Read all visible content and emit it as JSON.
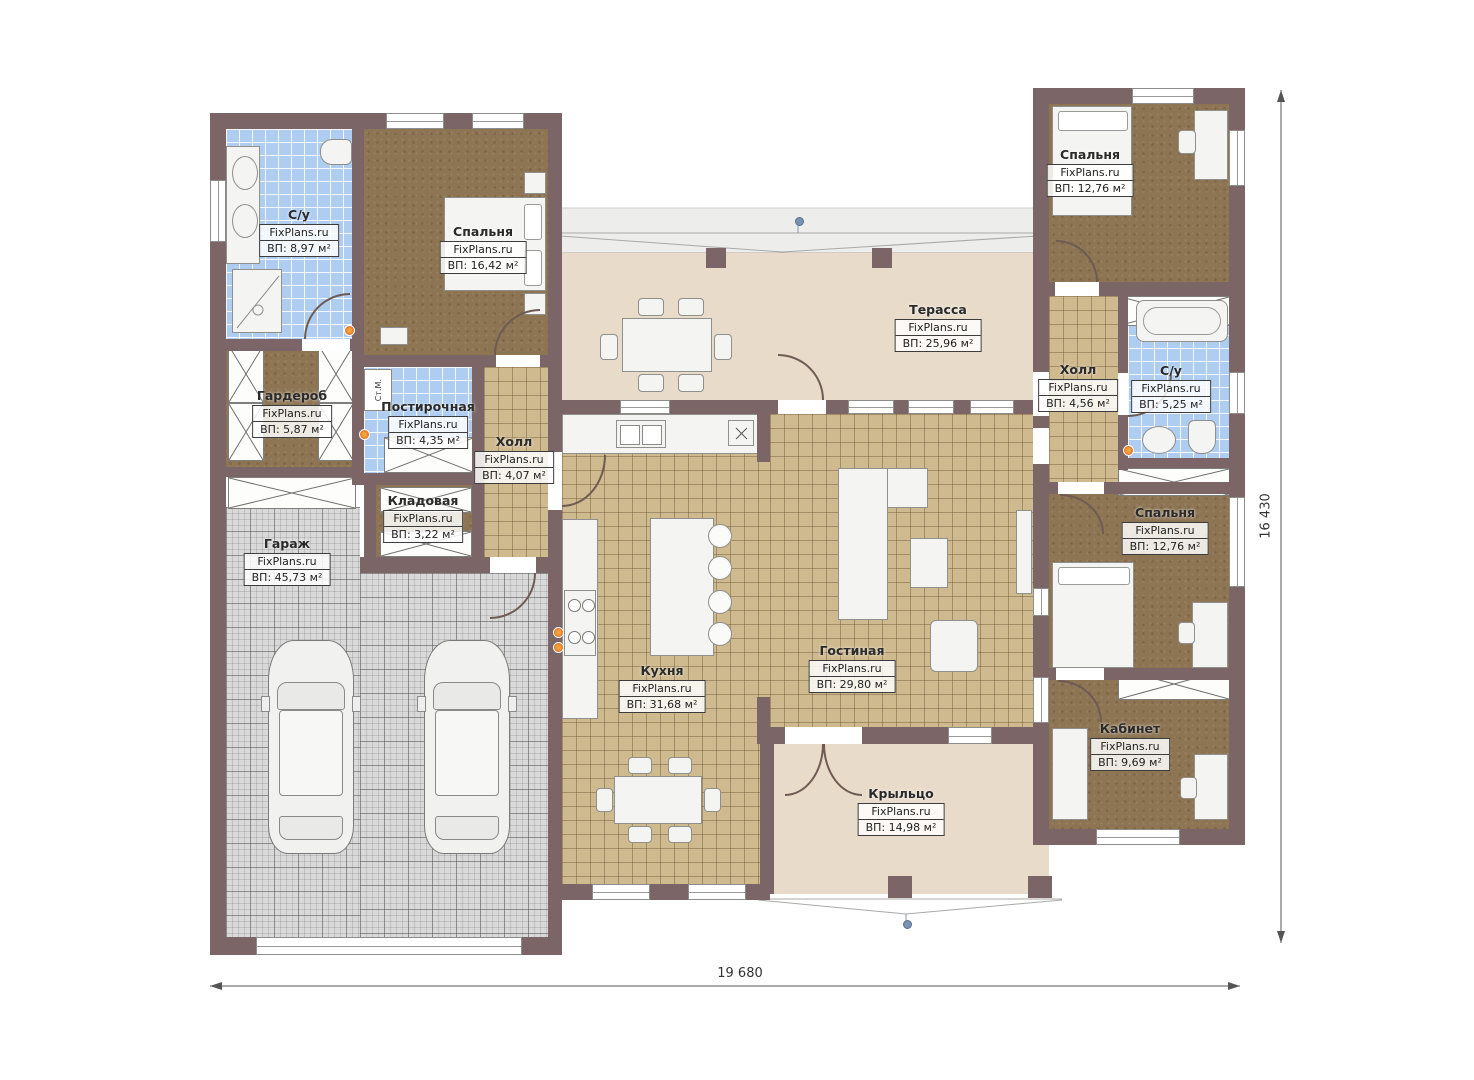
{
  "meta": {
    "watermark": "FixPlans.ru",
    "type": "floor-plan"
  },
  "dimensions": {
    "width_label": "19 680",
    "height_label": "16 430"
  },
  "annotations": {
    "washing_machine": "Ст.М."
  },
  "rooms": [
    {
      "id": "bathroom-left",
      "name": "С/у",
      "area": "ВП: 8,97 м²"
    },
    {
      "id": "bedroom-left",
      "name": "Спальня",
      "area": "ВП: 16,42 м²"
    },
    {
      "id": "wardrobe",
      "name": "Гардероб",
      "area": "ВП: 5,87 м²"
    },
    {
      "id": "laundry",
      "name": "Постирочная",
      "area": "ВП: 4,35 м²"
    },
    {
      "id": "hall-center",
      "name": "Холл",
      "area": "ВП: 4,07 м²"
    },
    {
      "id": "pantry",
      "name": "Кладовая",
      "area": "ВП: 3,22 м²"
    },
    {
      "id": "garage",
      "name": "Гараж",
      "area": "ВП: 45,73 м²"
    },
    {
      "id": "terrace",
      "name": "Терасса",
      "area": "ВП: 25,96 м²"
    },
    {
      "id": "kitchen",
      "name": "Кухня",
      "area": "ВП: 31,68 м²"
    },
    {
      "id": "living-room",
      "name": "Гостиная",
      "area": "ВП: 29,80 м²"
    },
    {
      "id": "bedroom-top-right",
      "name": "Спальня",
      "area": "ВП: 12,76 м²"
    },
    {
      "id": "hall-right",
      "name": "Холл",
      "area": "ВП: 4,56 м²"
    },
    {
      "id": "bathroom-right",
      "name": "С/у",
      "area": "ВП: 5,25 м²"
    },
    {
      "id": "bedroom-right",
      "name": "Спальня",
      "area": "ВП: 12,76 м²"
    },
    {
      "id": "office",
      "name": "Кабинет",
      "area": "ВП: 9,69 м²"
    },
    {
      "id": "porch",
      "name": "Крыльцо",
      "area": "ВП: 14,98 м²"
    }
  ],
  "colors": {
    "wall": "#7c6566",
    "tile_floor": "#cfb98e",
    "bath_floor": "#aecdf0",
    "bedroom_floor": "#8d7553",
    "garage_floor": "#d9d9d9",
    "terrace_floor": "#e8dbc9",
    "light_dot": "#e06a1f",
    "ridge_dot": "#7b92b5"
  }
}
